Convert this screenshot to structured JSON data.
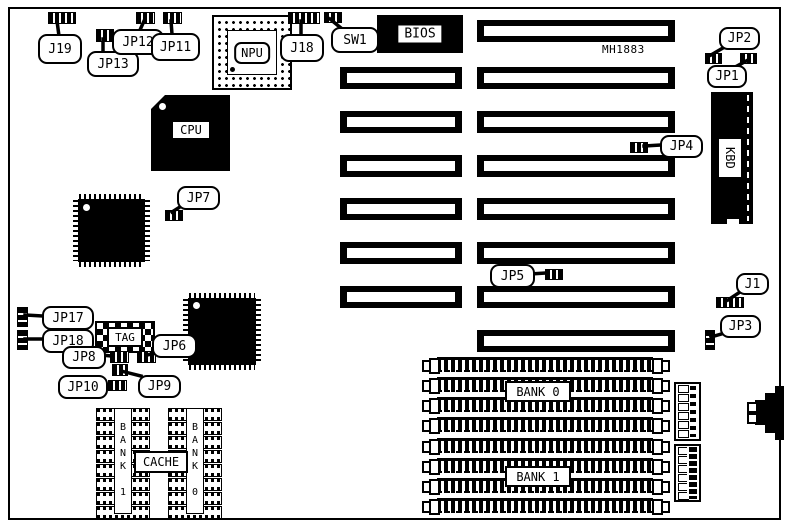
{
  "board": {
    "model": "MH1883"
  },
  "chips": {
    "cpu": "CPU",
    "npu": "NPU",
    "bios": "BIOS",
    "kbd": "KBD",
    "tag": "TAG",
    "cache": "CACHE",
    "cache_bank_left": "BANK 1",
    "cache_bank_right": "BANK 0"
  },
  "memory": {
    "bank0": "BANK 0",
    "bank1": "BANK 1"
  },
  "jumpers": {
    "j19": "J19",
    "jp13": "JP13",
    "jp12": "JP12",
    "jp11": "JP11",
    "j18": "J18",
    "sw1": "SW1",
    "jp2": "JP2",
    "jp1": "JP1",
    "jp4": "JP4",
    "jp7": "JP7",
    "jp5": "JP5",
    "j1": "J1",
    "jp3": "JP3",
    "jp17": "JP17",
    "jp18": "JP18",
    "jp8": "JP8",
    "jp6": "JP6",
    "jp9": "JP9",
    "jp10": "JP10"
  }
}
